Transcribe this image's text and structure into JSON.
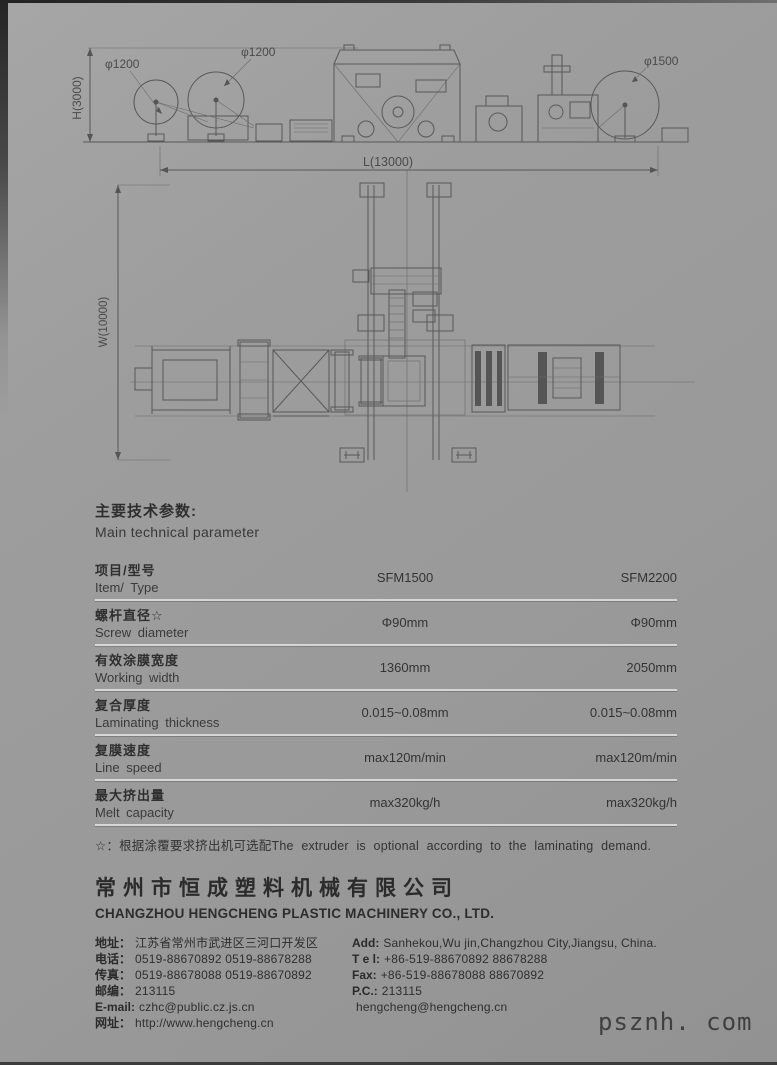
{
  "drawings": {
    "side_view": {
      "dim_reel_left": "φ1200",
      "dim_reel_mid": "φ1200",
      "dim_reel_right": "φ1500",
      "dim_height": "H(3000)",
      "dim_length": "L(13000)"
    },
    "plan_view": {
      "dim_width": "W(10000)"
    }
  },
  "parameters": {
    "title_zh": "主要技术参数:",
    "title_en": "Main technical parameter",
    "header": {
      "zh": "项目/型号",
      "en": "Item/ Type"
    },
    "columns": [
      "SFM1500",
      "SFM2200"
    ],
    "rows": [
      {
        "zh": "螺杆直径☆",
        "en": "Screw diameter",
        "v1": "Φ90mm",
        "v2": "Φ90mm"
      },
      {
        "zh": "有效涂膜宽度",
        "en": "Working width",
        "v1": "1360mm",
        "v2": "2050mm"
      },
      {
        "zh": "复合厚度",
        "en": "Laminating thickness",
        "v1": "0.015~0.08mm",
        "v2": "0.015~0.08mm"
      },
      {
        "zh": "复膜速度",
        "en": "Line speed",
        "v1": "max120m/min",
        "v2": "max120m/min"
      },
      {
        "zh": "最大挤出量",
        "en": "Melt capacity",
        "v1": "max320kg/h",
        "v2": "max320kg/h"
      }
    ],
    "footnote": "☆：根据涂覆要求挤出机可选配The extruder is optional according to the laminating demand."
  },
  "company": {
    "name_zh": "常州市恒成塑料机械有限公司",
    "name_en": "CHANGZHOU HENGCHENG PLASTIC MACHINERY CO., LTD.",
    "contact_left": [
      {
        "label": "地址：",
        "value": "江苏省常州市武进区三河口开发区"
      },
      {
        "label": "电话：",
        "value": "0519-88670892  0519-88678288"
      },
      {
        "label": "传真：",
        "value": "0519-88678088  0519-88670892"
      },
      {
        "label": "邮编：",
        "value": "213115"
      },
      {
        "label": "E-mail:",
        "value": "czhc@public.cz.js.cn"
      },
      {
        "label": "网址：",
        "value": "http://www.hengcheng.cn"
      }
    ],
    "contact_right": [
      {
        "label": "Add:",
        "value": "Sanhekou,Wu jin,Changzhou City,Jiangsu, China."
      },
      {
        "label": "T e l:",
        "value": "+86-519-88670892  88678288"
      },
      {
        "label": "Fax:",
        "value": "+86-519-88678088  88670892"
      },
      {
        "label": "P.C.:",
        "value": "213115"
      },
      {
        "label": "",
        "value": "hengcheng@hengcheng.cn"
      }
    ]
  },
  "page": {
    "watermark": "psznh. com"
  }
}
